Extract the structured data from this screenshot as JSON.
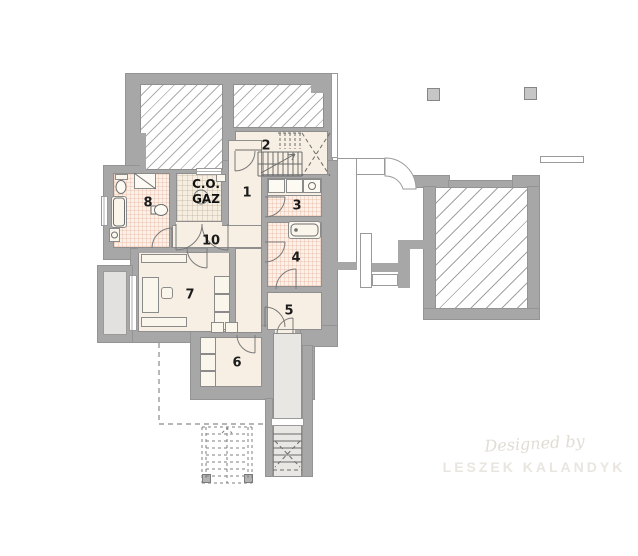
{
  "title": "Basement floor plan",
  "rooms": {
    "r1": "1",
    "r2": "2",
    "r3": "3",
    "r4": "4",
    "r5": "5",
    "r6": "6",
    "r7": "7",
    "r8": "8",
    "r10": "10"
  },
  "boiler_room": {
    "line1": "C.O.",
    "line2": "GAZ"
  },
  "watermark": {
    "line1": "Designed by",
    "line2": "LESZEK KALANDYK"
  },
  "colors": {
    "wall": "#a7a7a7",
    "floor": "#f7efe3",
    "tile_floor": "#fcf1e8",
    "boiler_floor": "#f6eee1",
    "stair_corridor_floor": "#e8e7e4",
    "hatch_line": "#aeaeae",
    "background": "#ffffff"
  }
}
